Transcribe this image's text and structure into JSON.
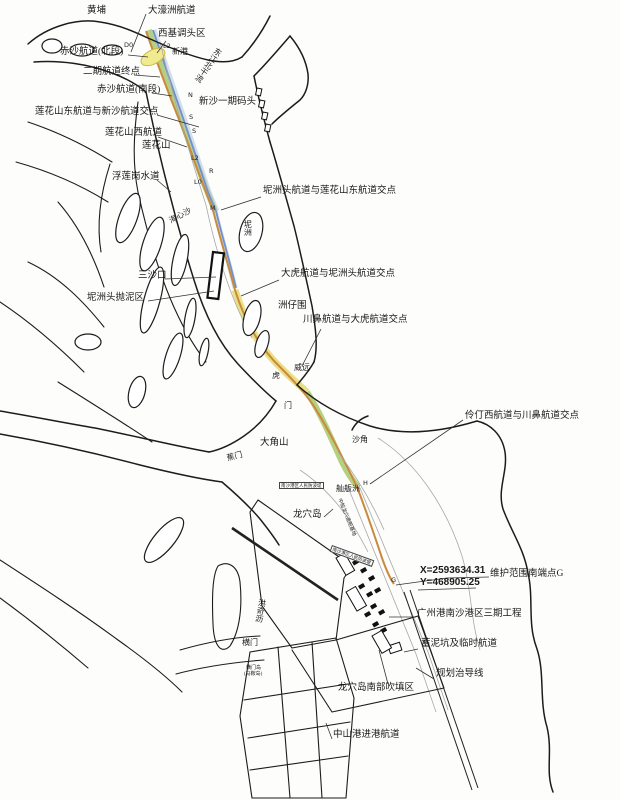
{
  "labels": {
    "huangpu": "黄埔",
    "dahaozhou_channel": "大濠洲航道",
    "xiji_turning_basin": "西基调头区",
    "xingang": "新港",
    "dongjiang_north": "东江北干流",
    "chisha_north": "赤沙航道(北段)",
    "phase2_end": "二期航道终点",
    "chisha_south": "赤沙航道(南段)",
    "xinsha_wharf": "新沙一期码头",
    "lianhua_east_junction": "莲花山东航道与新沙航道交点",
    "lianhua_west_channel": "莲花山西航道",
    "lianhuashan": "莲花山",
    "fuliangang": "浮莲岗水道",
    "haixinsha": "海心沙",
    "nizhou": "坭洲",
    "nizhoutou_junction": "坭洲头航道与莲花山东航道交点",
    "sanshakou": "三沙口",
    "dumping_area": "坭洲头抛泥区",
    "dahu_junction": "大虎航道与坭洲头航道交点",
    "zhouzaiwei": "洲仔围",
    "chuanbi_junction": "川鼻航道与大虎航道交点",
    "weiyuan": "威远",
    "hu": "虎",
    "men": "门",
    "dajiaoshan": "大角山",
    "shajiao": "沙角",
    "lingding_junction": "伶仃西航道与川鼻航道交点",
    "shanbanzhou": "舢舨洲",
    "longxue_island": "龙穴岛",
    "coord_x": "X=2593634.31",
    "coord_y": "Y=468905.25",
    "south_endpoint": "维护范围南端点G",
    "nansha_phase3": "广州港南沙港区三期工程",
    "mud_pit": "蓄泥坑及临时航道",
    "guide_line": "规划治导线",
    "reclamation": "龙穴岛南部吹填区",
    "hengmen": "横门",
    "hengmen_island": "横门岛",
    "maan_island": "(马鞍岛)",
    "zhongshan_channel": "中山港进港航道",
    "hongqili": "洪奇沥",
    "jiaomen": "蕉门",
    "shipyard": "中船龙穴造船基地",
    "breakwater1": "南沙港区人民防波堤",
    "breakwater2": "南沙港区人民防波堤"
  },
  "channel_markers": {
    "d0": "D0",
    "l2": "L2",
    "n": "N",
    "s1": "S",
    "s2": "S",
    "l2b": "L2",
    "r": "R",
    "l0": "L0",
    "m": "M",
    "h": "H",
    "g": "G"
  },
  "colors": {
    "channel_green": "#a9c86b",
    "channel_yellow": "#e8dc74",
    "channel_blue": "#6f92c9",
    "channel_pale_blue": "#b9cbe2",
    "line_orange": "#c98a3e",
    "basin_yellow": "#f2ea8e",
    "coast": "#1c1c1c"
  }
}
